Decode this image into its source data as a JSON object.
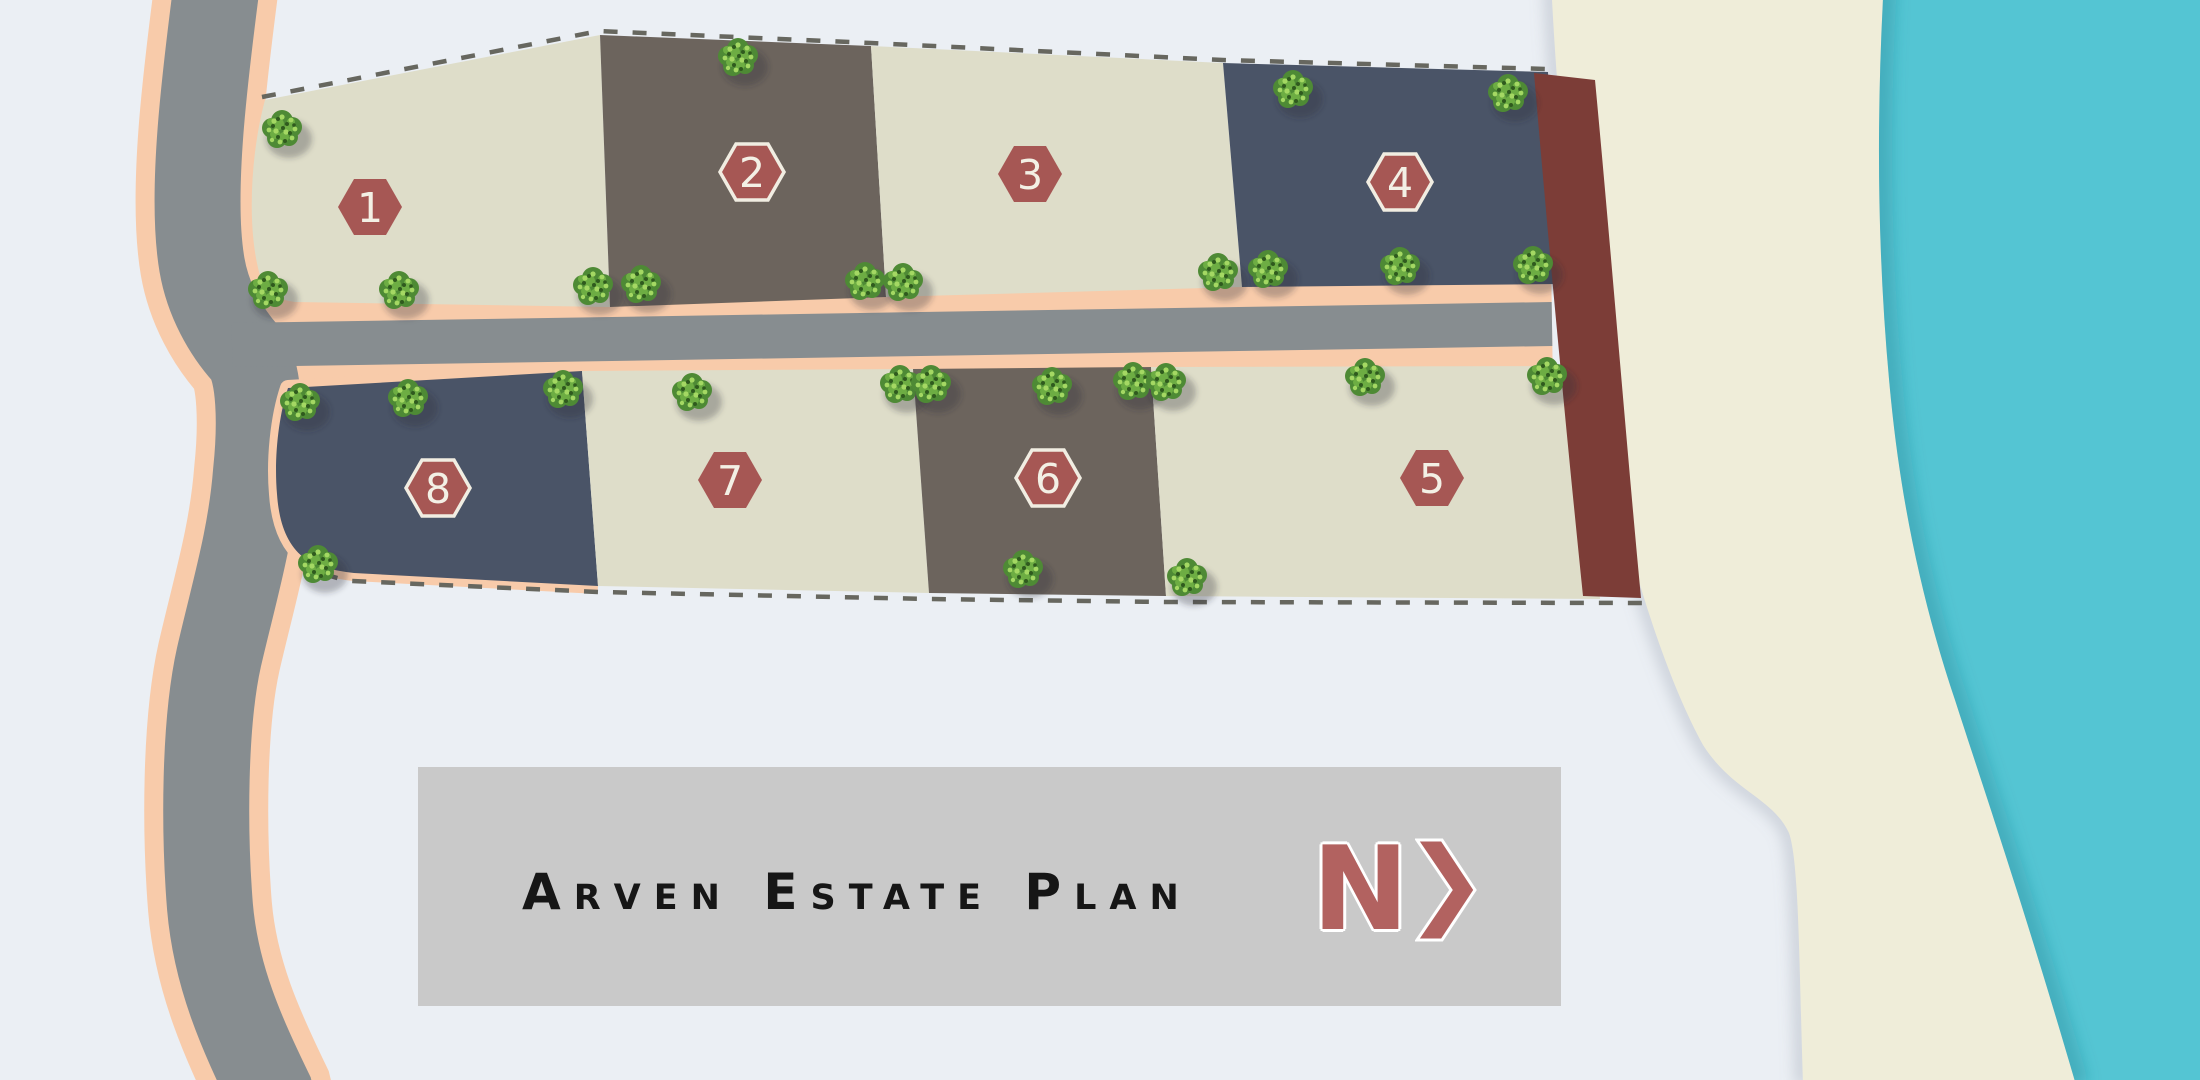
{
  "title_card": {
    "title": "Arven Estate Plan",
    "north_label": "N",
    "north_arrow_icon": "chevron-right"
  },
  "lots": [
    {
      "id": 1,
      "label": "1",
      "shade": "cream"
    },
    {
      "id": 2,
      "label": "2",
      "shade": "brown"
    },
    {
      "id": 3,
      "label": "3",
      "shade": "cream"
    },
    {
      "id": 4,
      "label": "4",
      "shade": "blue"
    },
    {
      "id": 5,
      "label": "5",
      "shade": "cream"
    },
    {
      "id": 6,
      "label": "6",
      "shade": "brown"
    },
    {
      "id": 7,
      "label": "7",
      "shade": "cream"
    },
    {
      "id": 8,
      "label": "8",
      "shade": "blue"
    }
  ],
  "map": {
    "features": [
      "curved-access-road",
      "internal-street",
      "beach",
      "water",
      "reserve-strip",
      "boundary-dashes",
      "trees"
    ],
    "trees": [
      [
        282,
        130
      ],
      [
        738,
        58
      ],
      [
        1293,
        90
      ],
      [
        1508,
        94
      ],
      [
        268,
        291
      ],
      [
        399,
        291
      ],
      [
        593,
        287
      ],
      [
        641,
        285
      ],
      [
        865,
        282
      ],
      [
        903,
        283
      ],
      [
        1218,
        273
      ],
      [
        1268,
        270
      ],
      [
        1400,
        267
      ],
      [
        1533,
        266
      ],
      [
        300,
        403
      ],
      [
        408,
        399
      ],
      [
        563,
        390
      ],
      [
        692,
        393
      ],
      [
        900,
        385
      ],
      [
        931,
        385
      ],
      [
        1052,
        387
      ],
      [
        1133,
        382
      ],
      [
        1166,
        383
      ],
      [
        1365,
        378
      ],
      [
        1547,
        377
      ],
      [
        318,
        565
      ],
      [
        1023,
        570
      ],
      [
        1187,
        578
      ]
    ]
  },
  "colors": {
    "bg": "#EBEFF4",
    "water": "#54C5D3",
    "water_shadow": "#1E7A8C",
    "sand": "#EFEDD9",
    "sand_shadow": "#8B93A3",
    "maroon": "#7C3D37",
    "road": "#878D90",
    "road_edge": "#F8CBAA",
    "lot_cream": "#DEDDC9",
    "lot_brown": "#6C645D",
    "lot_blue": "#4A5467",
    "badge": "#A65754",
    "badge_outline": "#F1EDE2",
    "badge_text": "#F3F0E5",
    "dash": "#67675F",
    "title_box": "#C9C9C9",
    "title_text": "#161616",
    "north": "#B26260",
    "tree_base": "#4E8A35",
    "tree_mid": "#6DAD43",
    "tree_light": "#A4D863",
    "tree_dark": "#2F5A1E"
  }
}
